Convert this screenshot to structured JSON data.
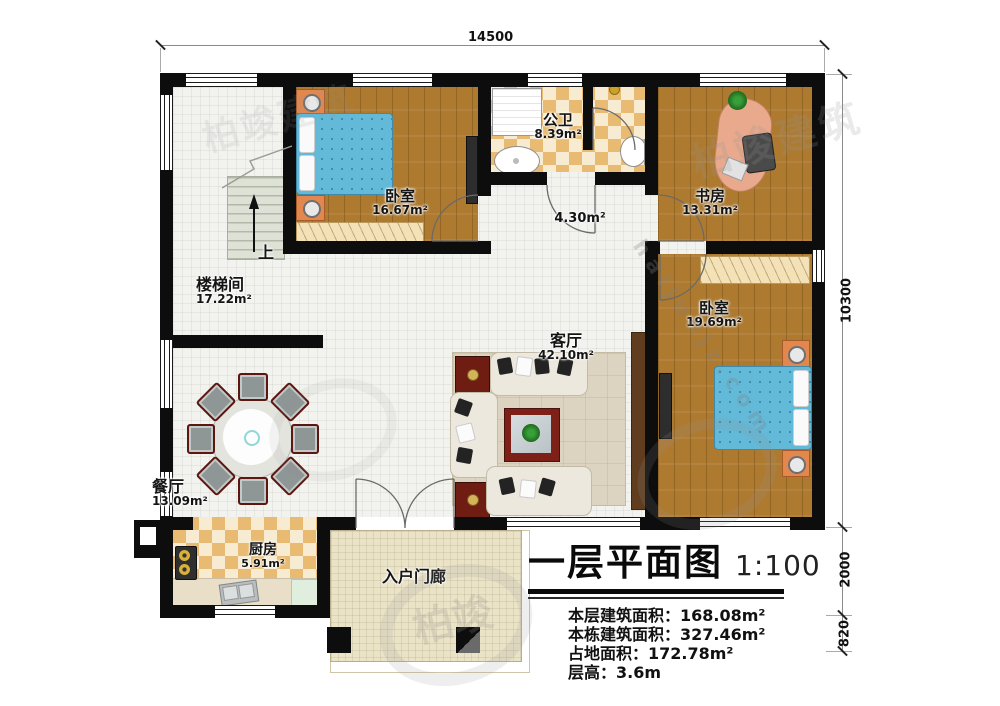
{
  "dims": {
    "top": "14500",
    "right": [
      "10300",
      "2000",
      "820"
    ]
  },
  "rooms": {
    "stairwell": {
      "name": "楼梯间",
      "area": "17.22m²"
    },
    "bedroom1": {
      "name": "卧室",
      "area": "16.67m²"
    },
    "bathroom": {
      "name": "公卫",
      "area": "8.39m²"
    },
    "study": {
      "name": "书房",
      "area": "13.31m²"
    },
    "corridor": {
      "area": "4.30m²"
    },
    "living": {
      "name": "客厅",
      "area": "42.10m²"
    },
    "bedroom2": {
      "name": "卧室",
      "area": "19.69m²"
    },
    "dining": {
      "name": "餐厅",
      "area": "13.09m²"
    },
    "kitchen": {
      "name": "厨房",
      "area": "5.91m²"
    },
    "porch": {
      "name": "入户门廊"
    }
  },
  "stairs": {
    "up_label": "上"
  },
  "title_block": {
    "title": "一层平面图",
    "scale": "1:100",
    "info_lines": [
      {
        "label": "本层建筑面积：",
        "value": "168.08m²"
      },
      {
        "label": "本栋建筑面积：",
        "value": "327.46m²"
      },
      {
        "label": "占地面积：",
        "value": "172.78m²"
      },
      {
        "label": "层高：",
        "value": "3.6m"
      }
    ]
  },
  "watermark": {
    "brand": "柏竣建筑",
    "brand_short": "柏竣",
    "site": "haijunjz.com"
  },
  "colors": {
    "wall": "#0d0d0d",
    "wood_floor": "#ad7a30",
    "tile_floor": "#f2f2ef",
    "checker_tan": "#e9bb72",
    "checker_cream": "#f7ecd2",
    "bed_blue": "#63b9d8",
    "nightstand_orange": "#e2884e",
    "accent_red": "#6f1d12",
    "porch_tan": "#ebe3c6",
    "rug_beige": "#dcd3c0",
    "stair_grey": "#dde1d6"
  }
}
